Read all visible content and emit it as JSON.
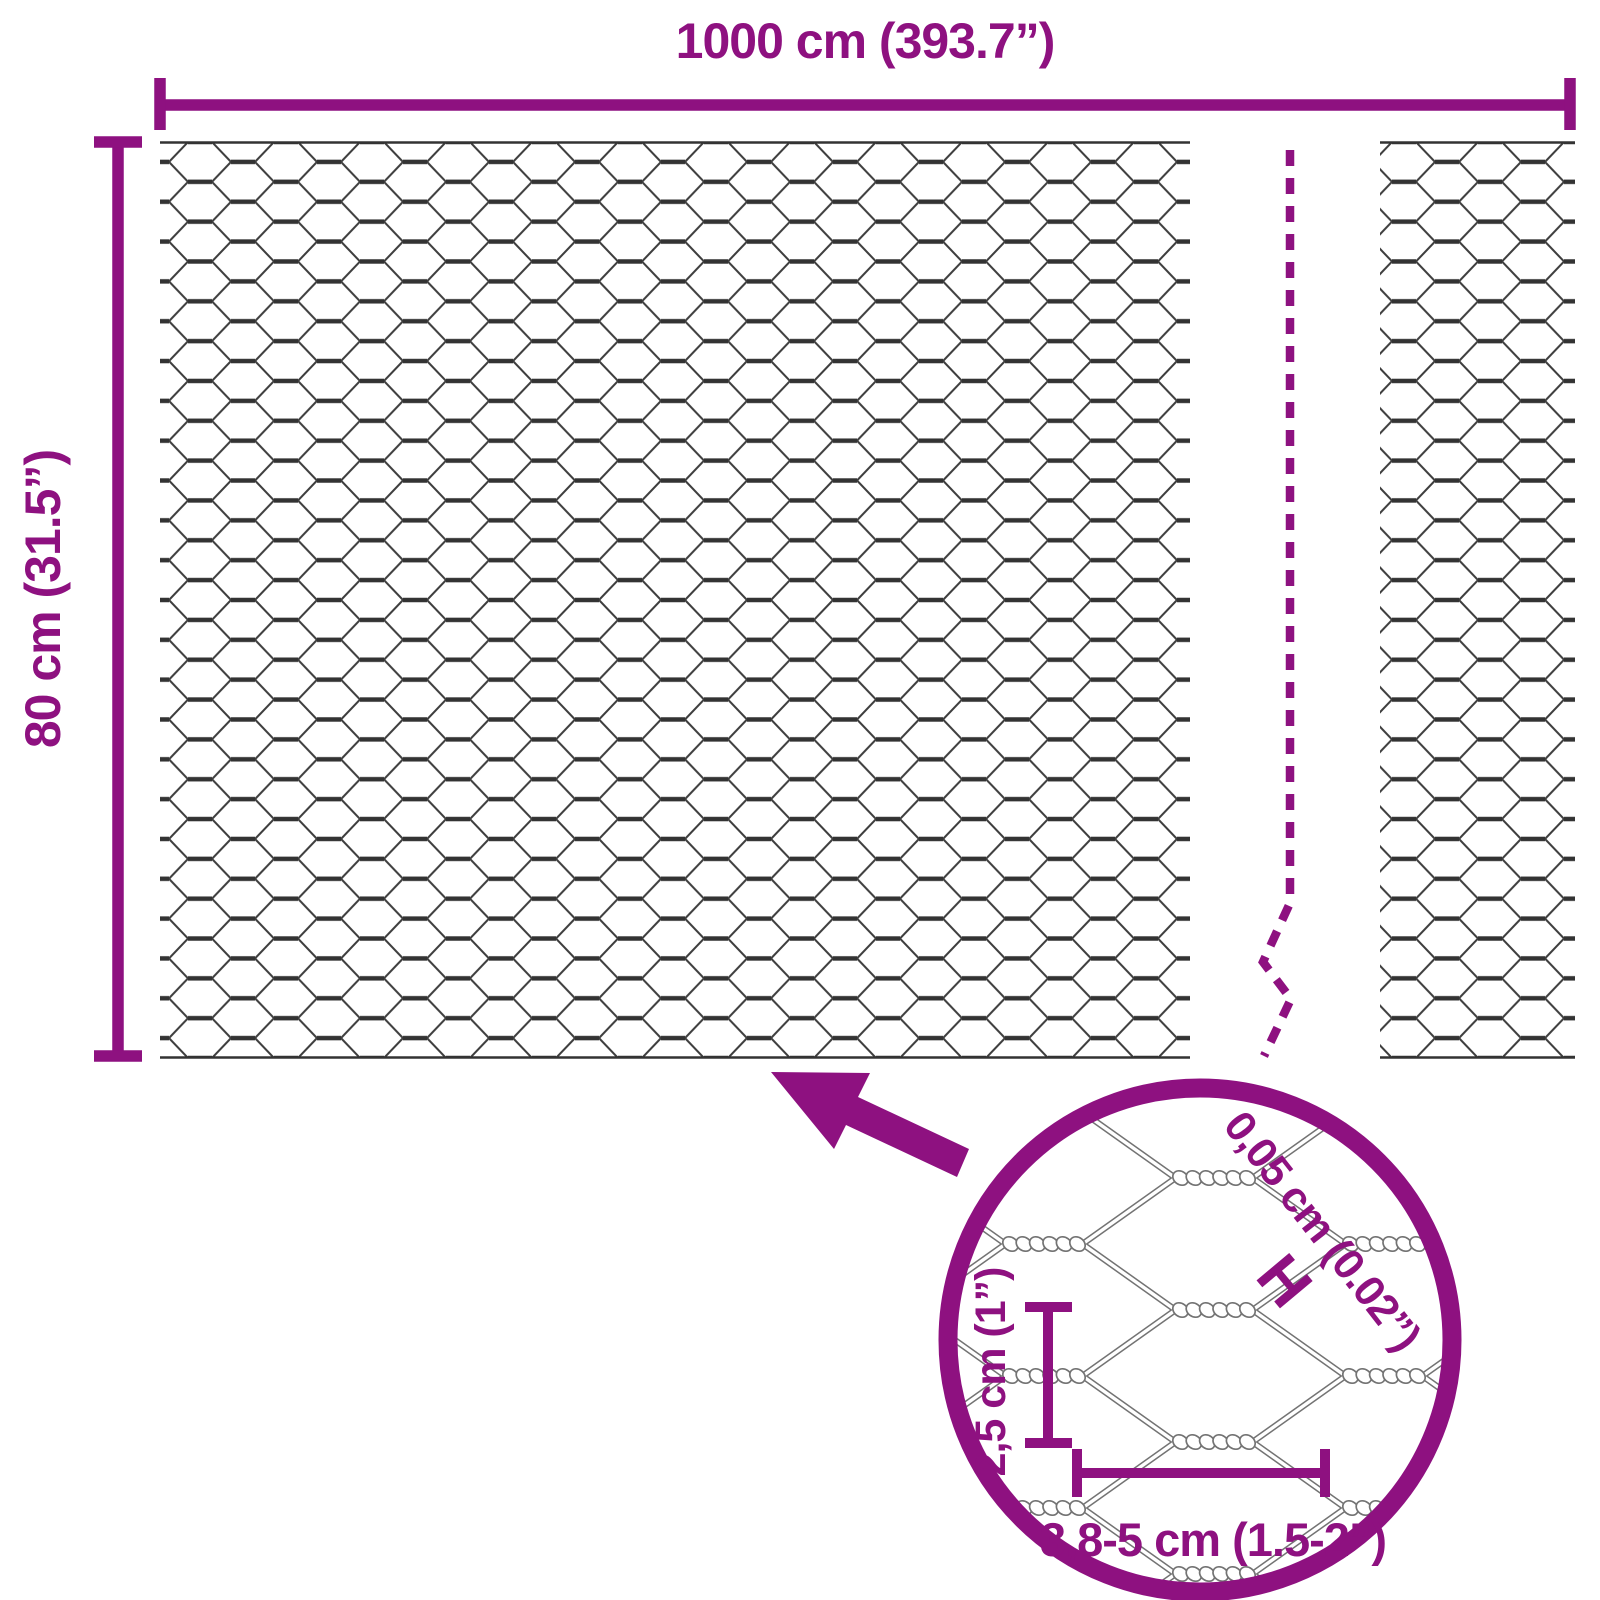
{
  "labels": {
    "total_length": "1000 cm (393.7”)",
    "roll_height": "80 cm (31.5”)",
    "wire_thickness": "0,05 cm (0.02”)",
    "wire_thickness_marker": "H",
    "mesh_height": "2,5 cm (1”)",
    "mesh_width": "3,8-5 cm (1.5-2”)"
  },
  "colors": {
    "accent": "#8E1180",
    "wire_dark": "#333333",
    "wire_mid": "#3E3E3E",
    "wire_light": "#737373",
    "background": "#FFFFFF"
  }
}
